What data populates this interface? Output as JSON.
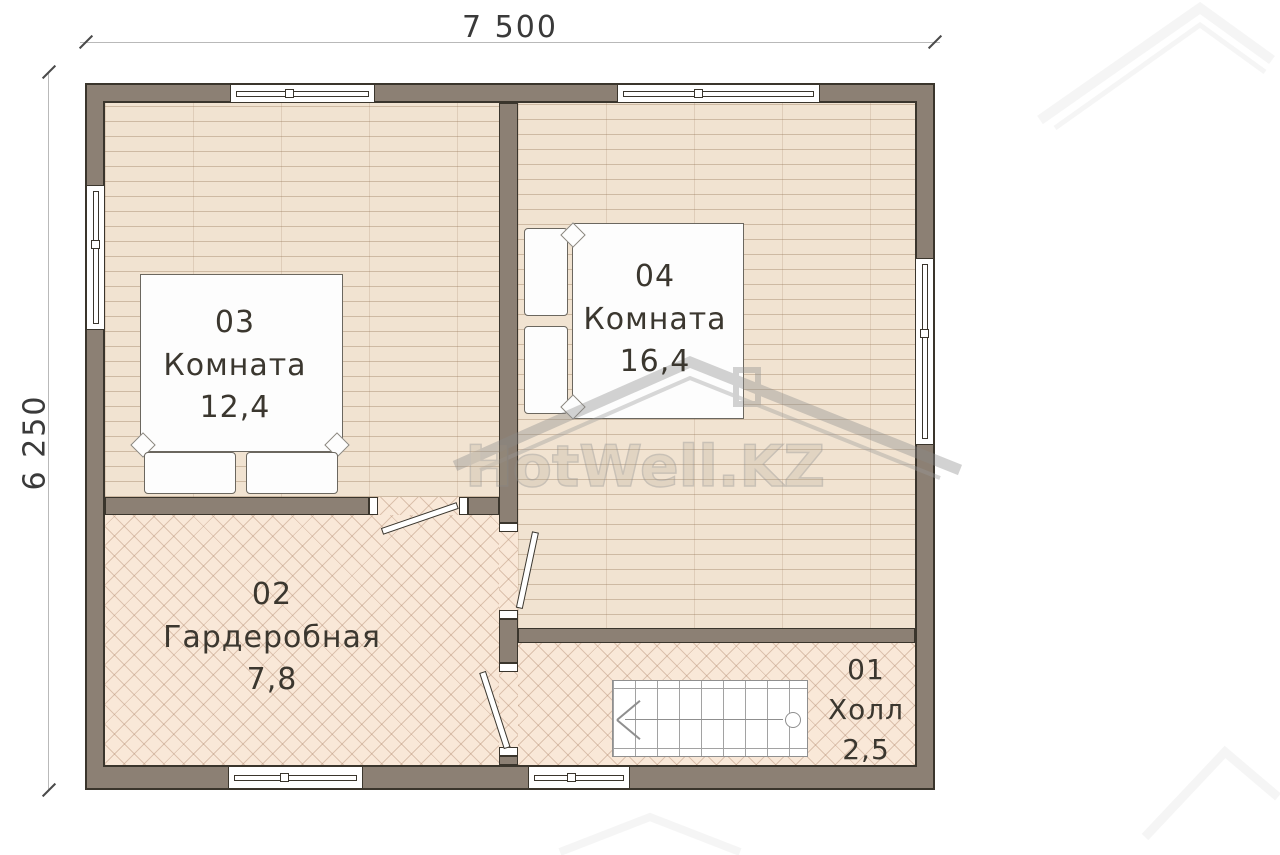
{
  "plan": {
    "width_label": "7 500",
    "height_label": "6 250"
  },
  "rooms": [
    {
      "number": "01",
      "name": "Холл",
      "area": "2,5"
    },
    {
      "number": "02",
      "name": "Гардеробная",
      "area": "7,8"
    },
    {
      "number": "03",
      "name": "Комната",
      "area": "12,4"
    },
    {
      "number": "04",
      "name": "Комната",
      "area": "16,4"
    }
  ],
  "watermark": {
    "brand": "HotWell.KZ"
  },
  "colors": {
    "wall": "#8c8074",
    "wood_floor": "#f1e3d1",
    "parquet_floor": "#f9e8d8",
    "outline": "#3a352c",
    "dimension_text": "#3a3a3a"
  }
}
